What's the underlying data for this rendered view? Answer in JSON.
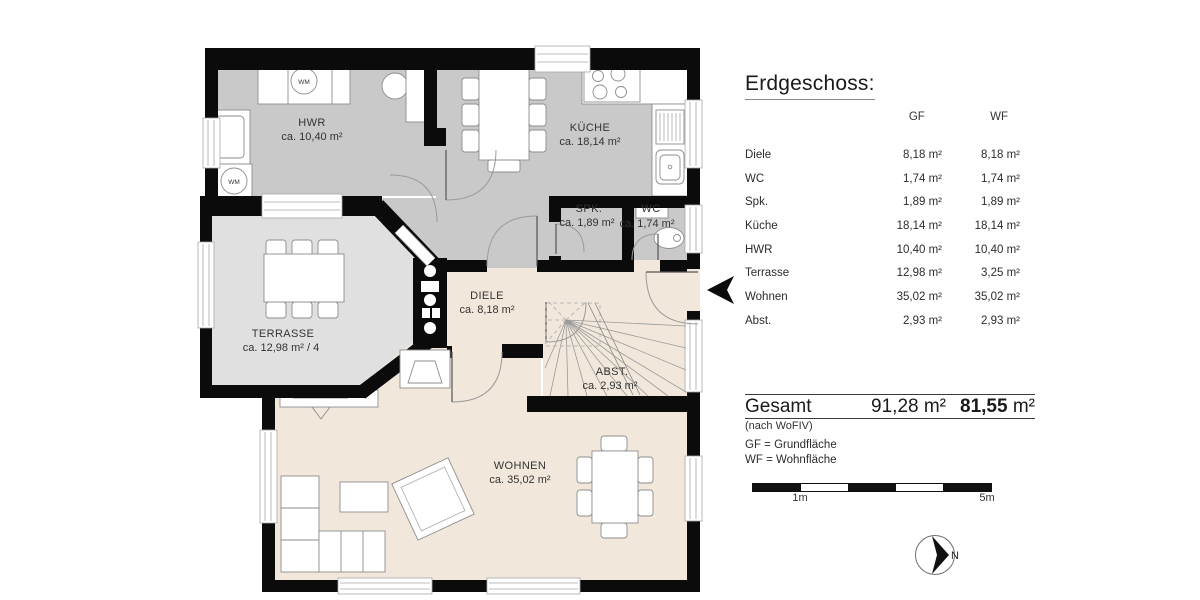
{
  "floorplan": {
    "rooms": [
      {
        "name": "HWR",
        "area": "ca. 10,40 m²"
      },
      {
        "name": "KÜCHE",
        "area": "ca. 18,14 m²"
      },
      {
        "name": "SPK.",
        "area": "ca. 1,89 m²"
      },
      {
        "name": "WC",
        "area": "ca. 1,74 m²"
      },
      {
        "name": "DIELE",
        "area": "ca. 8,18 m²"
      },
      {
        "name": "TERRASSE",
        "area": "ca. 12,98 m² / 4"
      },
      {
        "name": "ABST.",
        "area": "ca. 2,93 m²"
      },
      {
        "name": "WOHNEN",
        "area": "ca. 35,02 m²"
      }
    ],
    "wm_label": "WM"
  },
  "panel": {
    "title": "Erdgeschoss:",
    "columns": [
      "GF",
      "WF"
    ],
    "rows": [
      {
        "label": "Diele",
        "gf": "8,18 m²",
        "wf": "8,18 m²"
      },
      {
        "label": "WC",
        "gf": "1,74 m²",
        "wf": "1,74 m²"
      },
      {
        "label": "Spk.",
        "gf": "1,89 m²",
        "wf": "1,89 m²"
      },
      {
        "label": "Küche",
        "gf": "18,14 m²",
        "wf": "18,14 m²"
      },
      {
        "label": "HWR",
        "gf": "10,40 m²",
        "wf": "10,40 m²"
      },
      {
        "label": "Terrasse",
        "gf": "12,98 m²",
        "wf": "3,25 m²"
      },
      {
        "label": "Wohnen",
        "gf": "35,02 m²",
        "wf": "35,02 m²"
      },
      {
        "label": "Abst.",
        "gf": "2,93 m²",
        "wf": "2,93 m²"
      }
    ],
    "total": {
      "label": "Gesamt",
      "gf": "91,28 m²",
      "wf_value": "81,55",
      "wf_unit": " m²",
      "note": "(nach WoFIV)"
    },
    "legend": [
      "GF = Grundfläche",
      "WF = Wohnfläche"
    ],
    "scalebar": {
      "left": "1m",
      "right": "5m"
    },
    "compass": {
      "label": "N"
    }
  },
  "colors": {
    "wall": "#0b0b0b",
    "room_gray": "#c9c9c9",
    "terrace_gray": "#e0e0e0",
    "wood_beige": "#f1e8db"
  }
}
